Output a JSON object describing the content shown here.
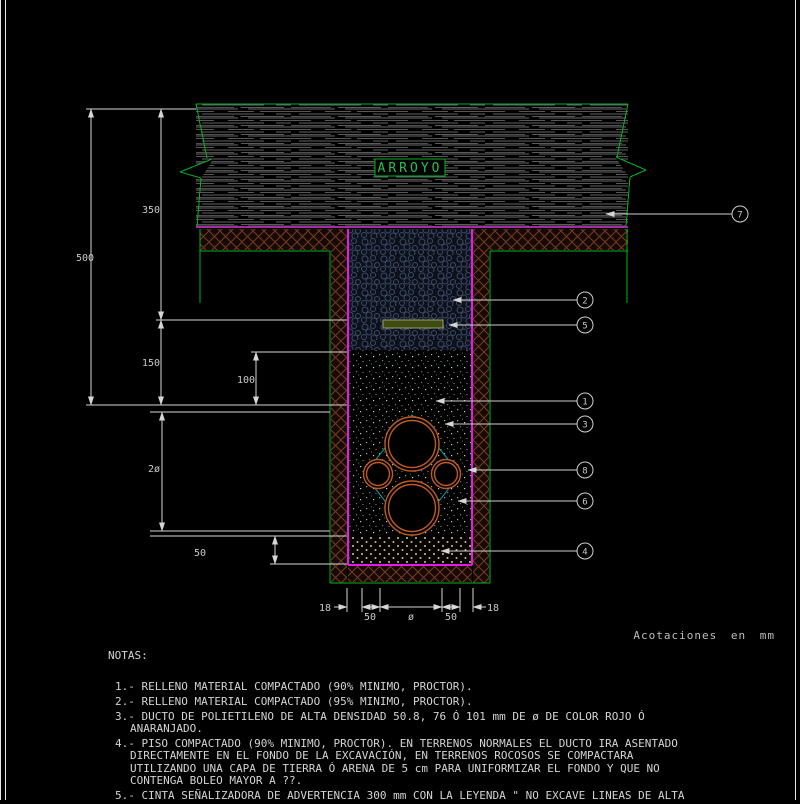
{
  "drawing": {
    "arroyo_label": "ARROYO",
    "acotaciones": "Acotaciones en mm",
    "dims": {
      "d500": "500",
      "d350": "350",
      "d150": "150",
      "d100": "100",
      "d2dia": "2ø",
      "d50floor": "50",
      "b18l": "18",
      "b50l": "50",
      "bdia": "ø",
      "b50r": "50",
      "b18r": "18"
    },
    "callouts": [
      {
        "num": "7"
      },
      {
        "num": "2"
      },
      {
        "num": "5"
      },
      {
        "num": "1"
      },
      {
        "num": "3"
      },
      {
        "num": "8"
      },
      {
        "num": "6"
      },
      {
        "num": "4"
      }
    ],
    "colors": {
      "green": "#00b41e",
      "magenta": "#e51ae5",
      "magenta_dim": "#a629a6",
      "duct_orange": "#bf5b27",
      "diamond_cyan": "#00a8a8",
      "dim_gray": "#d6d6d6",
      "tape_olive": "#3f4a12"
    }
  },
  "notes": {
    "title": "NOTAS:",
    "items": [
      {
        "lines": [
          "1.- RELLENO MATERIAL COMPACTADO (90% MINIMO, PROCTOR)."
        ]
      },
      {
        "lines": [
          "2.- RELLENO MATERIAL COMPACTADO (95% MINIMO, PROCTOR)."
        ]
      },
      {
        "lines": [
          "3.- DUCTO DE POLIETILENO DE ALTA DENSIDAD 50.8, 76 Ó 101 mm DE ø DE COLOR ROJO Ó",
          "ANARANJADO."
        ]
      },
      {
        "lines": [
          "4.- PISO COMPACTADO (90% MINIMO, PROCTOR). EN TERRENOS NORMALES EL DUCTO IRA ASENTADO",
          "DIRECTAMENTE EN EL FONDO DE LA EXCAVACIÓN, EN TERRENOS ROCOSOS SE COMPACTARA",
          "UTILIZANDO UNA CAPA DE TIERRA Ó ARENA DE 5 cm PARA UNIFORMIZAR EL FONDO Y QUE NO",
          "CONTENGA BOLEO MAYOR A ??."
        ]
      },
      {
        "lines": [
          "5.- CINTA SEÑALIZADORA DE ADVERTENCIA 300 mm CON LA LEYENDA \" NO EXCAVE LINEAS DE ALTA"
        ]
      }
    ]
  }
}
